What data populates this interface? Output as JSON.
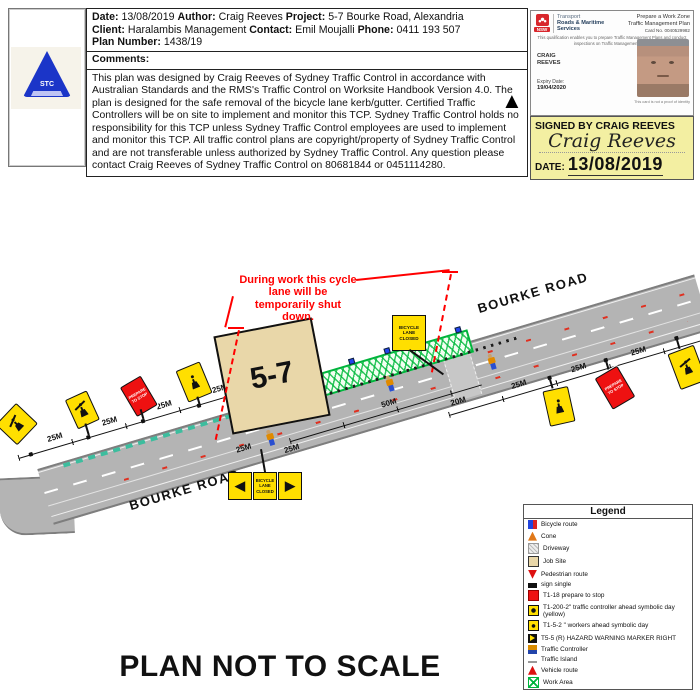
{
  "page": {
    "footer_title": "PLAN NOT TO SCALE"
  },
  "logo": {
    "text": "STC"
  },
  "header": {
    "info": {
      "date_label": "Date:",
      "date_value": "13/08/2019",
      "author_label": "Author:",
      "author_value": "Craig Reeves",
      "project_label": "Project:",
      "project_value": "5-7 Bourke Road, Alexandria",
      "client_label": "Client:",
      "client_value": "Haralambis Management",
      "contact_label": "Contact:",
      "contact_value": "Emil Moujalli",
      "phone_label": "Phone:",
      "phone_value": "0411 193 507",
      "plan_label": "Plan Number:",
      "plan_value": "1438/19"
    },
    "comments_label": "Comments:",
    "comments_text": "This plan was designed by Craig Reeves of Sydney Traffic Control in accordance with Australian Standards and the RMS's Traffic Control on Worksite Handbook Version 4.0. The plan is designed for the safe removal of the bicycle lane kerb/gutter. Certified Traffic Controllers will be on site to implement and monitor this TCP. Sydney Traffic Control holds no responsibility for this TCP unless Sydney Traffic Control employees are used to implement and monitor this TCP. All traffic control plans are copyright/property of Sydney Traffic Control and are not transferable unless authorized by Sydney Traffic Control. Any question please contact Craig Reeves of Sydney Traffic Control on 80681844 or 0451114280."
  },
  "card": {
    "nsw": "NSW",
    "agency_top": "Transport",
    "agency_bold1": "Roads & Maritime",
    "agency_bold2": "Services",
    "title1": "Prepare a Work Zone",
    "title2": "Traffic Management Plan",
    "card_no_label": "Card No.",
    "card_no_value": "0040529982",
    "description": "This qualification enables you to prepare Traffic Management Plans and conduct inspections on Traffic Management Plans",
    "holder1": "CRAIG",
    "holder2": "REEVES",
    "expiry_label": "Expiry Date:",
    "expiry_value": "19/04/2020",
    "footnote": "This card is not a proof of identity"
  },
  "signed": {
    "heading": "SIGNED BY CRAIG REEVES",
    "signature": "Craig Reeves",
    "date_label": "DATE:",
    "date_value": "13/08/2019"
  },
  "diagram": {
    "north_arrow": "▲",
    "road_name": "BOURKE ROAD",
    "building_label": "5-7",
    "annotation": "During work this cycle lane will be temporarily shut down.",
    "bicycle_lane_closed": "BICYCLE LANE CLOSED",
    "prepare_to_stop": "PREPARE TO STOP",
    "chevron_left": "◀",
    "chevron_right": "▶",
    "distances": [
      "25M",
      "25M",
      "25M",
      "25M",
      "25M",
      "25M",
      "50M",
      "20M",
      "25M",
      "25M",
      "25M"
    ]
  },
  "legend": {
    "title": "Legend",
    "items": [
      {
        "icon": "bicycle-route-icon",
        "label": "Bicycle route"
      },
      {
        "icon": "cone-icon",
        "label": "Cone"
      },
      {
        "icon": "driveway-icon",
        "label": "Driveway"
      },
      {
        "icon": "job-site-icon",
        "label": "Job Site"
      },
      {
        "icon": "pedestrian-route-icon",
        "label": "Pedestrian route"
      },
      {
        "icon": "sign-single-icon",
        "label": "sign single"
      },
      {
        "icon": "t1-18-icon",
        "label": "T1-18 prepare to stop"
      },
      {
        "icon": "t1-200-2-icon",
        "label": "T1-200-2\" traffic controller ahead symbolic day (yellow)"
      },
      {
        "icon": "t1-5-2-icon",
        "label": "T1-5-2 \" workers ahead symbolic day"
      },
      {
        "icon": "t5-5-icon",
        "label": "T5-5 (R) HAZARD WARNING MARKER RIGHT"
      },
      {
        "icon": "traffic-controller-icon",
        "label": "Traffic Controller"
      },
      {
        "icon": "traffic-island-icon",
        "label": "Traffic Island"
      },
      {
        "icon": "vehicle-route-icon",
        "label": "Vehicle route"
      },
      {
        "icon": "work-area-icon",
        "label": "Work Area"
      }
    ]
  },
  "colors": {
    "sign_yellow": "#ffdf00",
    "work_green": "#00b43c",
    "alert_red": "#ee1111",
    "road_gray": "#b4b4b4",
    "signed_yellow": "#f3efa2",
    "building_tan": "#e9d7a9"
  }
}
